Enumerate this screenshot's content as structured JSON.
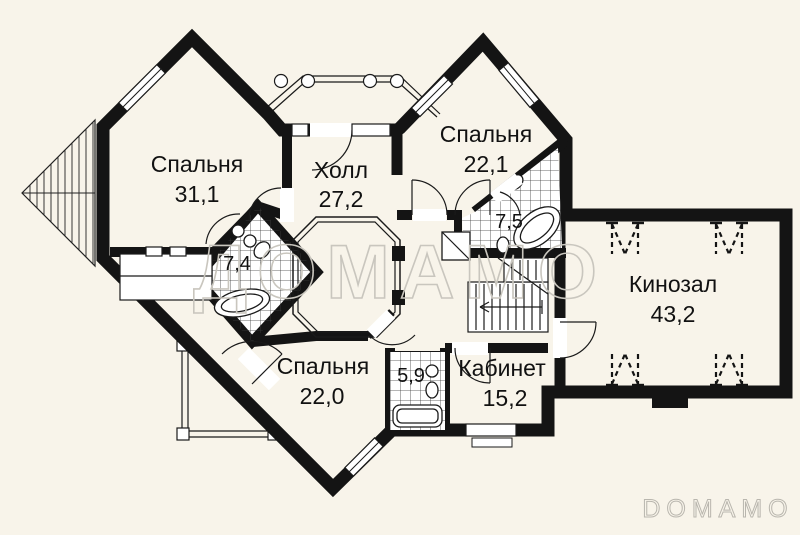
{
  "plan_title": "floor-plan",
  "watermarks": {
    "center": "ДОМАМО",
    "corner": "DOMAMO"
  },
  "rooms": {
    "bedroom1": {
      "name": "Спальня",
      "area": "31,1"
    },
    "hall": {
      "name": "Холл",
      "area": "27,2"
    },
    "bedroom2": {
      "name": "Спальня",
      "area": "22,1"
    },
    "bath_top": {
      "area": "7,5"
    },
    "bath_left": {
      "area": "7,4"
    },
    "cinema": {
      "name": "Кинозал",
      "area": "43,2"
    },
    "bedroom3": {
      "name": "Спальня",
      "area": "22,0"
    },
    "bath_bottom": {
      "area": "5,9"
    },
    "office": {
      "name": "Кабинет",
      "area": "15,2"
    }
  },
  "colors": {
    "background": "#f8f4ea",
    "room_fill": "#ffffff",
    "wall": "#141414",
    "watermark_center": "#c9c6be",
    "watermark_corner": "#b9b6ae"
  }
}
